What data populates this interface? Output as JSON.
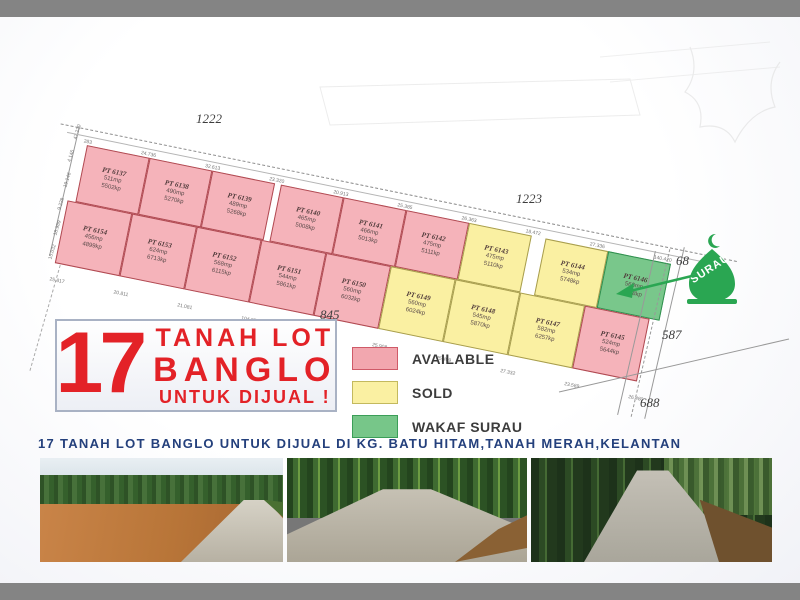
{
  "title_box": {
    "number": "17",
    "line1": "TANAH LOT",
    "line2": "BANGLO",
    "line3": "UNTUK DIJUAL !"
  },
  "caption": "17 TANAH LOT BANGLO UNTUK DIJUAL DI KG. BATU HITAM,TANAH MERAH,KELANTAN",
  "legend": [
    {
      "label": "AVAILABLE",
      "fill": "#f2a7af",
      "border": "#cf5a68"
    },
    {
      "label": "SOLD",
      "fill": "#faf0a2",
      "border": "#c3b95e"
    },
    {
      "label": "WAKAF SURAU",
      "fill": "#77c689",
      "border": "#3b9e58"
    }
  ],
  "surau": {
    "label": "SURAU",
    "color": "#2aa652"
  },
  "roads": [
    {
      "label": "1222",
      "x": 196,
      "y": 94
    },
    {
      "label": "1223",
      "x": 516,
      "y": 174
    },
    {
      "label": "845",
      "x": 320,
      "y": 290
    },
    {
      "label": "68",
      "x": 676,
      "y": 236
    },
    {
      "label": "587",
      "x": 662,
      "y": 310
    },
    {
      "label": "688",
      "x": 640,
      "y": 378
    }
  ],
  "map": {
    "top_row": [
      {
        "id": "PT 6137",
        "area_m": "511mp",
        "area_f": "5502kp",
        "status": "available"
      },
      {
        "id": "PT 6138",
        "area_m": "490mp",
        "area_f": "5270kp",
        "status": "available"
      },
      {
        "id": "PT 6139",
        "area_m": "489mp",
        "area_f": "5268kp",
        "status": "available"
      },
      {
        "id": "PT 6140",
        "area_m": "465mp",
        "area_f": "5008kp",
        "status": "available",
        "notch": true
      },
      {
        "id": "PT 6141",
        "area_m": "466mp",
        "area_f": "5013kp",
        "status": "available"
      },
      {
        "id": "PT 6142",
        "area_m": "475mp",
        "area_f": "5111kp",
        "status": "available"
      },
      {
        "id": "PT 6143",
        "area_m": "475mp",
        "area_f": "5110kp",
        "status": "sold"
      },
      {
        "id": "PT 6144",
        "area_m": "534mp",
        "area_f": "5748kp",
        "status": "sold",
        "gap": true
      },
      {
        "id": "PT 6146",
        "area_m": "568mp",
        "area_f": "6118kp",
        "status": "wakaf"
      }
    ],
    "bottom_row": [
      {
        "id": "PT 6154",
        "area_m": "456mp",
        "area_f": "4899kp",
        "status": "available"
      },
      {
        "id": "PT 6153",
        "area_m": "624mp",
        "area_f": "6713kp",
        "status": "available"
      },
      {
        "id": "PT 6152",
        "area_m": "568mp",
        "area_f": "6115kp",
        "status": "available"
      },
      {
        "id": "PT 6151",
        "area_m": "544mp",
        "area_f": "5861kp",
        "status": "available"
      },
      {
        "id": "PT 6150",
        "area_m": "560mp",
        "area_f": "6032kp",
        "status": "available"
      },
      {
        "id": "PT 6149",
        "area_m": "560mp",
        "area_f": "6024kp",
        "status": "sold"
      },
      {
        "id": "PT 6148",
        "area_m": "545mp",
        "area_f": "5870kp",
        "status": "sold"
      },
      {
        "id": "PT 6147",
        "area_m": "582mp",
        "area_f": "6257kp",
        "status": "sold"
      },
      {
        "id": "PT 6145",
        "area_m": "524mp",
        "area_f": "5644kp",
        "status": "available"
      }
    ],
    "top_marks": [
      "283",
      "24.736",
      "32.613",
      "23.320",
      "20.913",
      "25.385",
      "26.363",
      "18.472",
      "27.336",
      "140.420"
    ],
    "bottom_marks": [
      "25.817",
      "20.811",
      "21.081",
      "104.973",
      "25.892",
      "25.908",
      "25.499",
      "27.332",
      "23.589",
      "26.480"
    ],
    "left_marks": [
      "47.230",
      "4.146",
      "19.146",
      "9.228",
      "18.989",
      "15.032"
    ]
  },
  "status_colors": {
    "available": {
      "fill": "#f5b3ba",
      "border": "#b04a52"
    },
    "sold": {
      "fill": "#faf0a2",
      "border": "#a79d4e"
    },
    "wakaf": {
      "fill": "#79c78b",
      "border": "#2f8f4e"
    }
  },
  "frame_color": "#848484",
  "accent_red": "#e32227",
  "caption_blue": "#24407c"
}
